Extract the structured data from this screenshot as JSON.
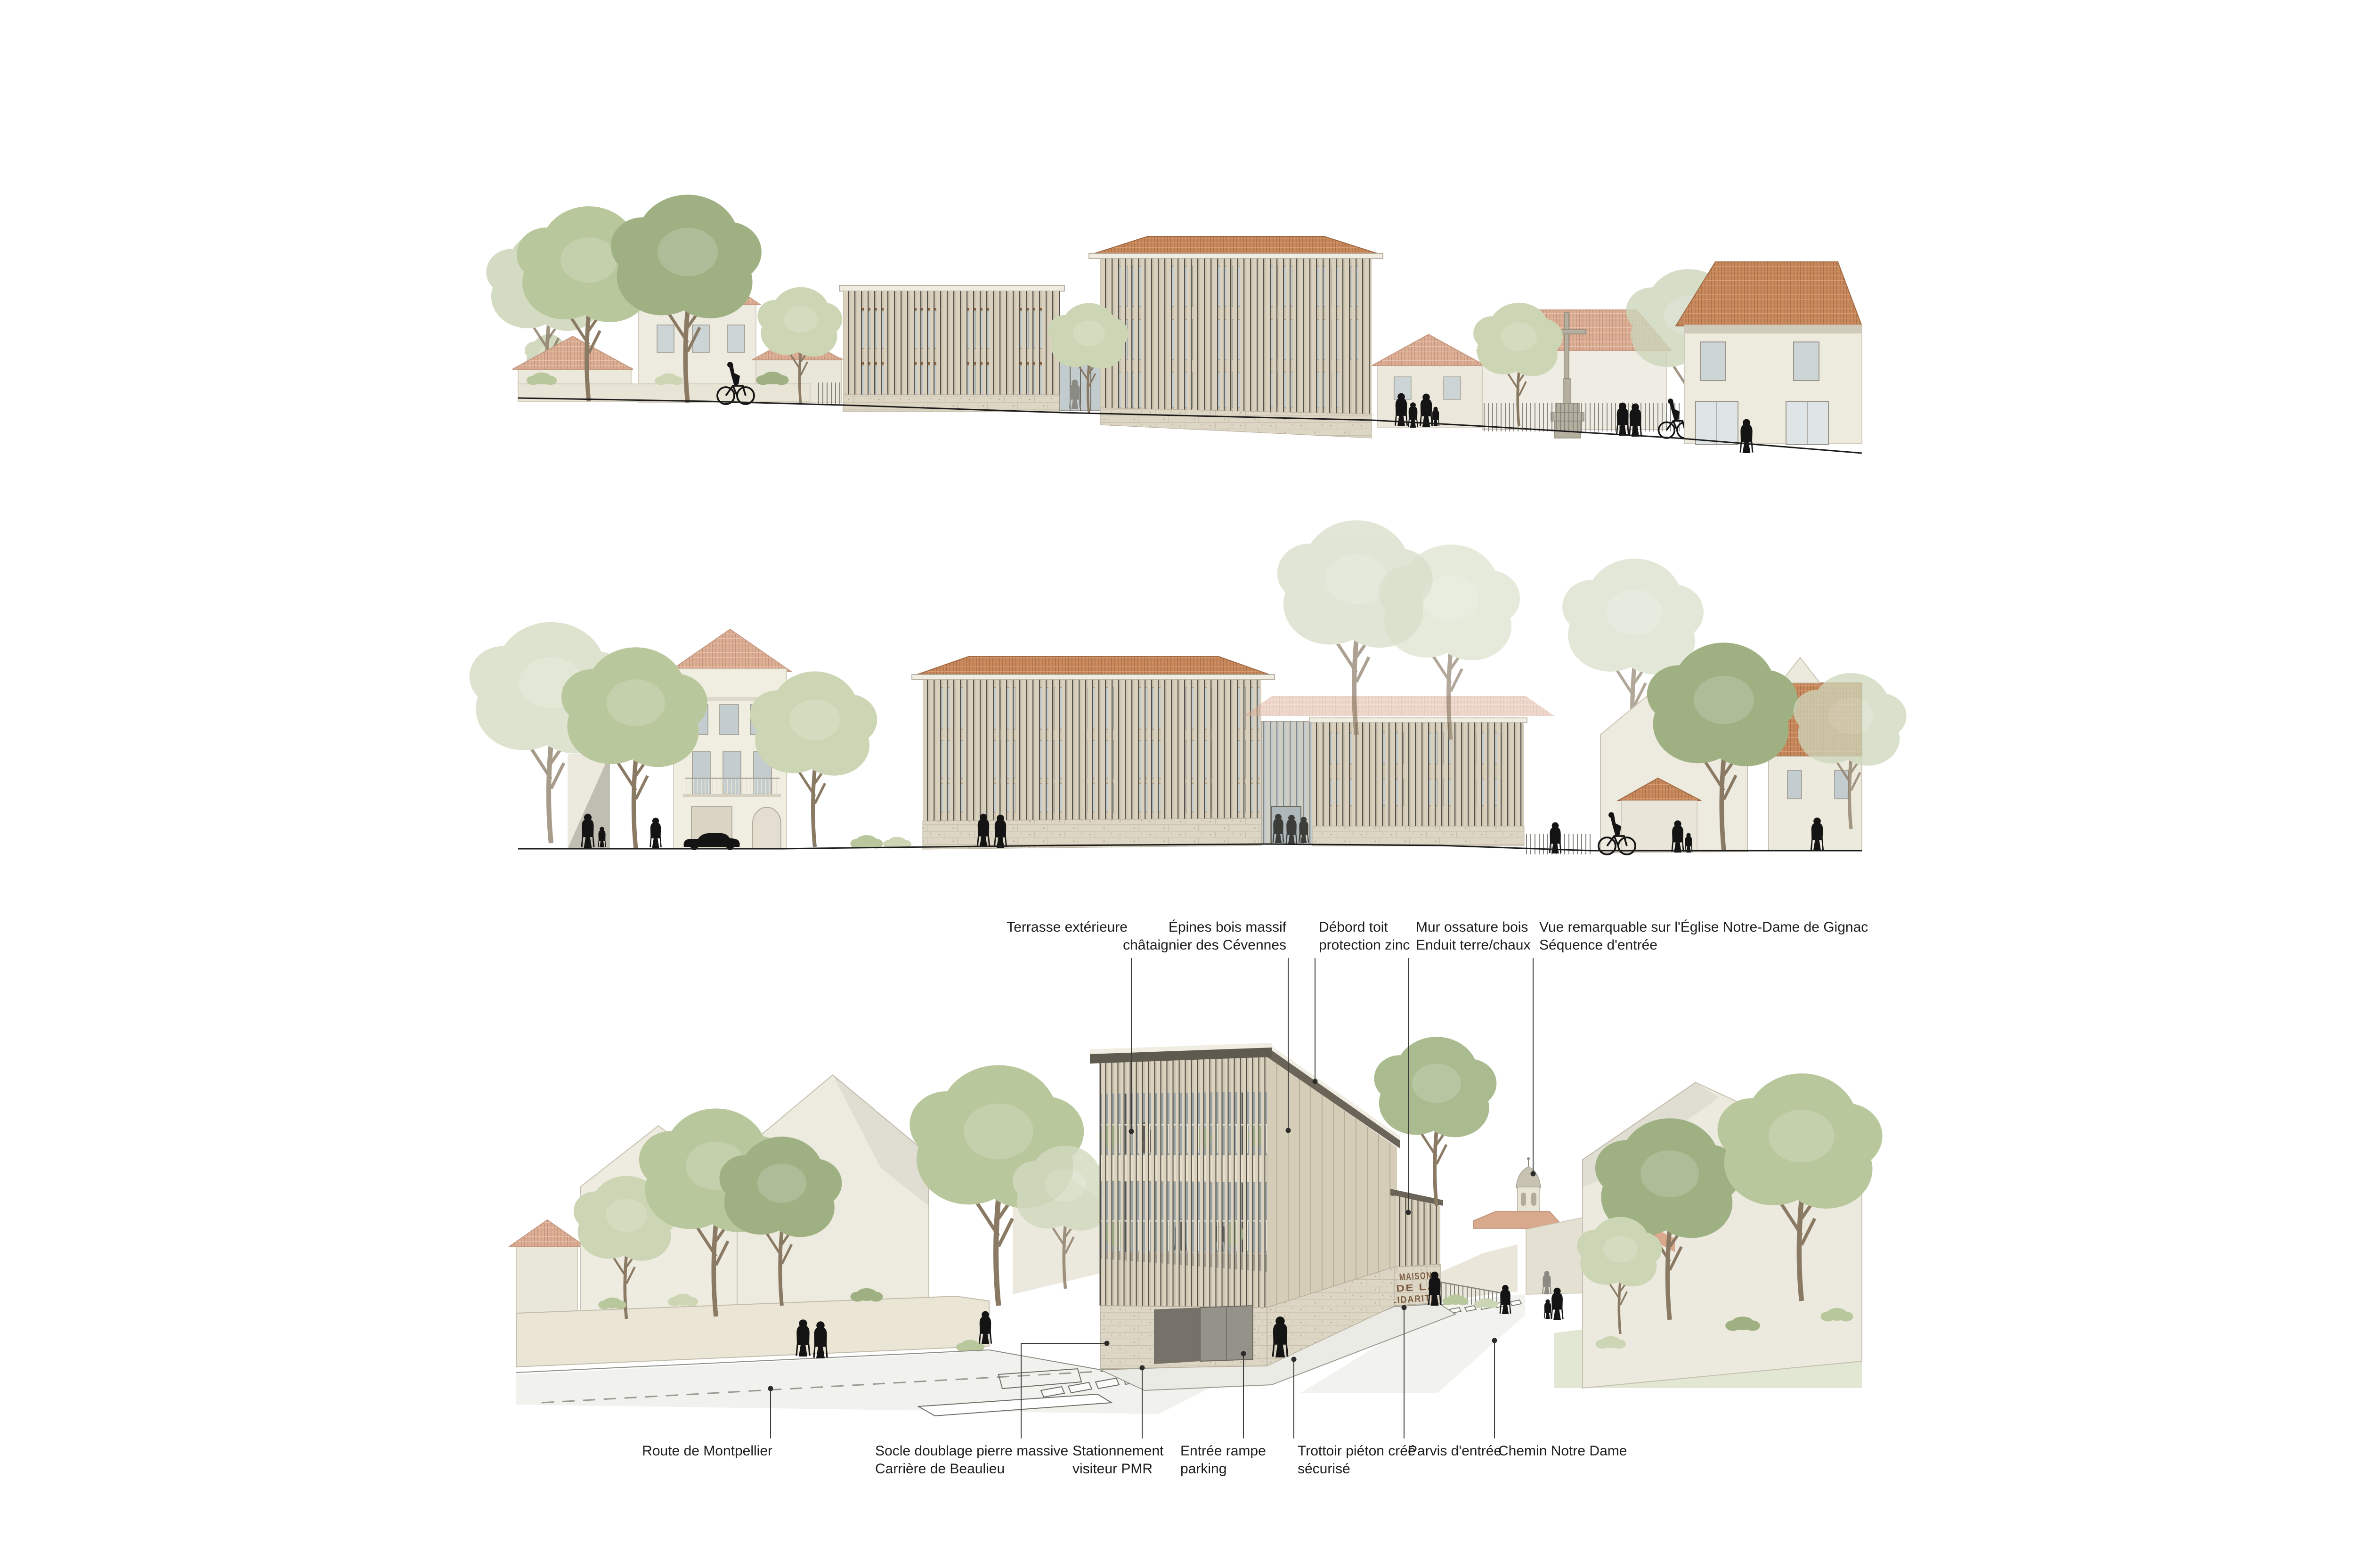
{
  "board": {
    "title": "Maison de la Solidarité – coupes / élévations / perspective",
    "sign": {
      "line1": "MAISON",
      "line2": "DE  LA",
      "line3": "SOLIDARITÉ"
    },
    "annotations_top": [
      {
        "label": "Terrasse extérieure"
      },
      {
        "label": "Épines bois massif\nchâtaignier des Cévennes"
      },
      {
        "label": "Débord toit\nprotection zinc"
      },
      {
        "label": "Mur ossature bois\nEnduit terre/chaux"
      },
      {
        "label": "Vue remarquable sur l'Église Notre-Dame de Gignac\nSéquence d'entrée"
      }
    ],
    "annotations_bottom": [
      {
        "label": "Route de Montpellier"
      },
      {
        "label": "Socle doublage pierre massive\nCarrière de Beaulieu"
      },
      {
        "label": "Stationnement\nvisiteur PMR"
      },
      {
        "label": "Entrée rampe\nparking"
      },
      {
        "label": "Trottoir piéton créé\nsécurisé"
      },
      {
        "label": "Parvis d'entrée"
      },
      {
        "label": "Chemin Notre Dame"
      }
    ],
    "colors": {
      "timber": "#cfc6b2",
      "fin_shadow": "#55514a",
      "stone": "#ddd6c5",
      "roof_orange": "#c8895c",
      "roof_pink": "#dcae94",
      "wall": "#edeadf",
      "green_dark": "#9fb183",
      "green_mid": "#b9c79c",
      "green_light": "#ccd6b4",
      "glass": "#c2cbce",
      "sign_brown": "#7d5b41",
      "line": "#3c3c3a"
    }
  }
}
